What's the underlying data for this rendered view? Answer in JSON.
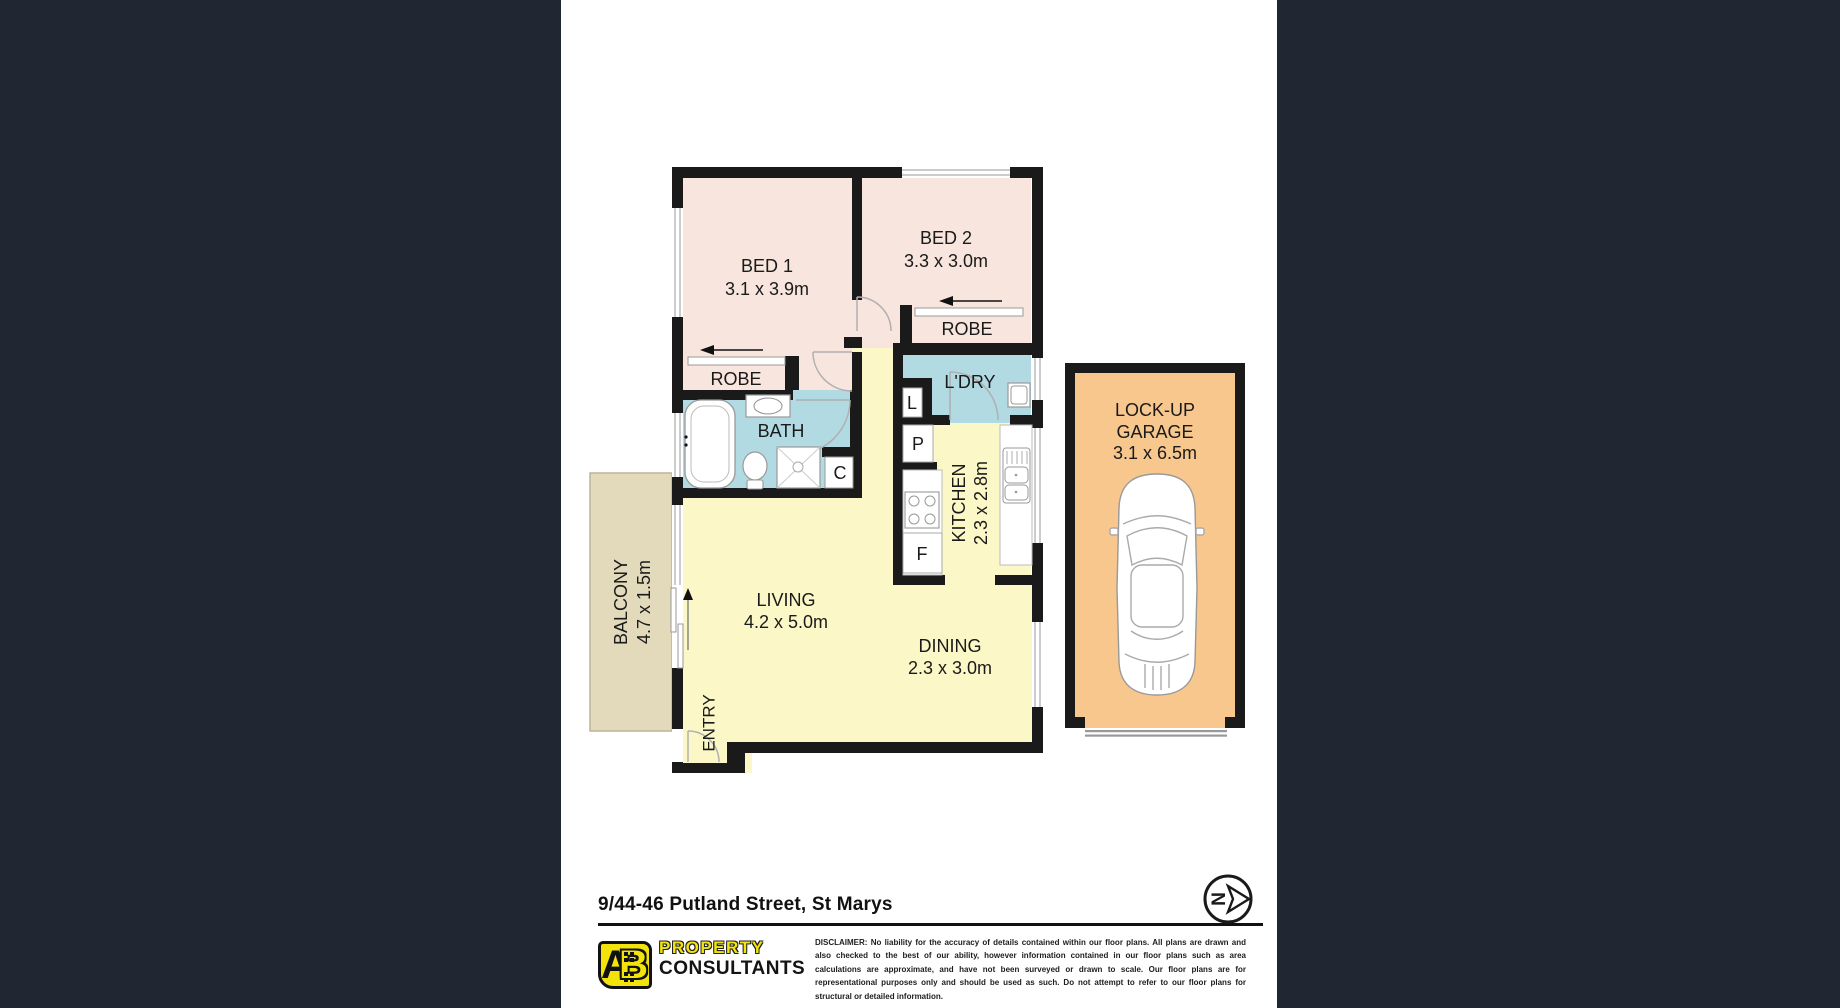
{
  "window": {
    "bars_color": "#212732",
    "sheet_color": "#ffffff"
  },
  "plan": {
    "rooms": {
      "bed1": {
        "name": "BED 1",
        "dims": "3.1 x 3.9m"
      },
      "bed2": {
        "name": "BED 2",
        "dims": "3.3 x 3.0m"
      },
      "robe1": {
        "name": "ROBE"
      },
      "robe2": {
        "name": "ROBE"
      },
      "laundry": {
        "name": "L'DRY"
      },
      "bath": {
        "name": "BATH"
      },
      "kitchen": {
        "name": "KITCHEN",
        "dims": "2.3 x 2.8m"
      },
      "living": {
        "name": "LIVING",
        "dims": "4.2 x 5.0m"
      },
      "dining": {
        "name": "DINING",
        "dims": "2.3 x 3.0m"
      },
      "balcony": {
        "name": "BALCONY",
        "dims": "4.7 x 1.5m"
      },
      "entry": {
        "name": "ENTRY"
      },
      "garage": {
        "name_line1": "LOCK-UP",
        "name_line2": "GARAGE",
        "dims": "3.1 x 6.5m"
      }
    },
    "markers": {
      "closet": "C",
      "linen": "L",
      "pantry": "P",
      "fridge": "F"
    },
    "compass": {
      "north": "N"
    },
    "colors": {
      "wall": "#1a1a1a",
      "bedroom": "#f8e5dd",
      "wet_area": "#b2dae2",
      "living_area": "#fbf7c7",
      "balcony": "#e3dabb",
      "garage": "#f7c78e"
    }
  },
  "footer": {
    "address": "9/44-46 Putland Street, St Marys",
    "logo": {
      "mark_a": "A",
      "mark_b": "B",
      "word1": "PROPERTY",
      "word2": "CONSULTANTS",
      "yellow": "#f2e30c"
    },
    "disclaimer_label": "DISCLAIMER:",
    "disclaimer_text": "No liability for the accuracy of details contained within our floor plans. All plans are drawn and also checked to the best of our ability, however information contained in our floor plans such as area calculations are approximate, and have not been surveyed or drawn to scale. Our floor plans are for representational purposes only and should be used as such. Do not attempt to refer to our floor plans for structural or detailed information."
  }
}
